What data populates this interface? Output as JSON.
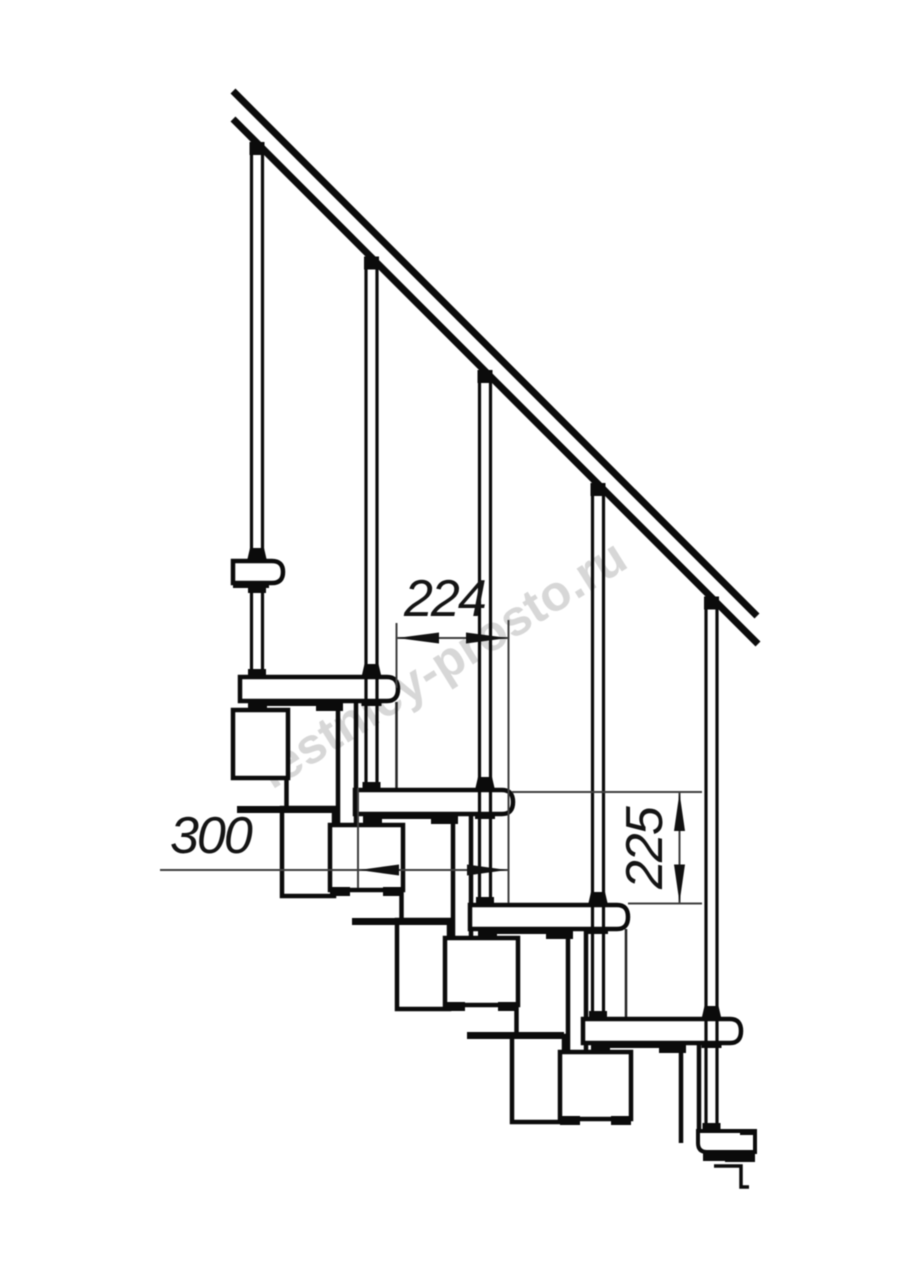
{
  "drawing": {
    "kind": "staircase side elevation technical drawing",
    "background_color": "#ffffff",
    "ink_color": "#0b0b0b",
    "dimension_line_color": "#3f3f3f",
    "treads_visible": 4,
    "balusters_visible": 5
  },
  "dimensions": {
    "run": {
      "value": "224",
      "orientation": "horizontal"
    },
    "depth": {
      "value": "300",
      "orientation": "horizontal"
    },
    "rise": {
      "value": "225",
      "orientation": "vertical"
    }
  },
  "watermark": {
    "text": "lestnicy-prosto.ru",
    "color": "#b6b6b6"
  }
}
